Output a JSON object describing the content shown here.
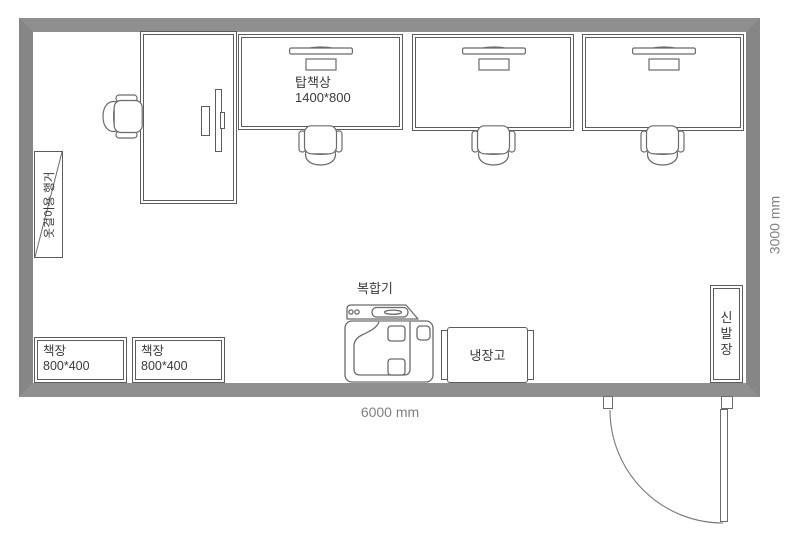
{
  "room": {
    "bottom_dimension": "6000 mm",
    "right_dimension": "3000 mm"
  },
  "furniture": {
    "desk": {
      "label_line1": "탑책상",
      "label_line2": "1400*800"
    },
    "hanger": {
      "label": "옷걸이용 행거"
    },
    "bookshelves": [
      {
        "line1": "책장",
        "line2": "800*400"
      },
      {
        "line1": "책장",
        "line2": "800*400"
      }
    ],
    "printer": {
      "label": "복합기"
    },
    "fridge": {
      "label": "냉장고"
    },
    "shoe_cabinet": {
      "chars": [
        "신",
        "발",
        "장"
      ]
    }
  },
  "colors": {
    "wall": "#8a8a8a",
    "line": "#6b6b6b",
    "furniture_border": "#5c5c5c",
    "label_text": "#3a3a3a",
    "dimension_text": "#7f7f7f",
    "background": "#ffffff"
  }
}
